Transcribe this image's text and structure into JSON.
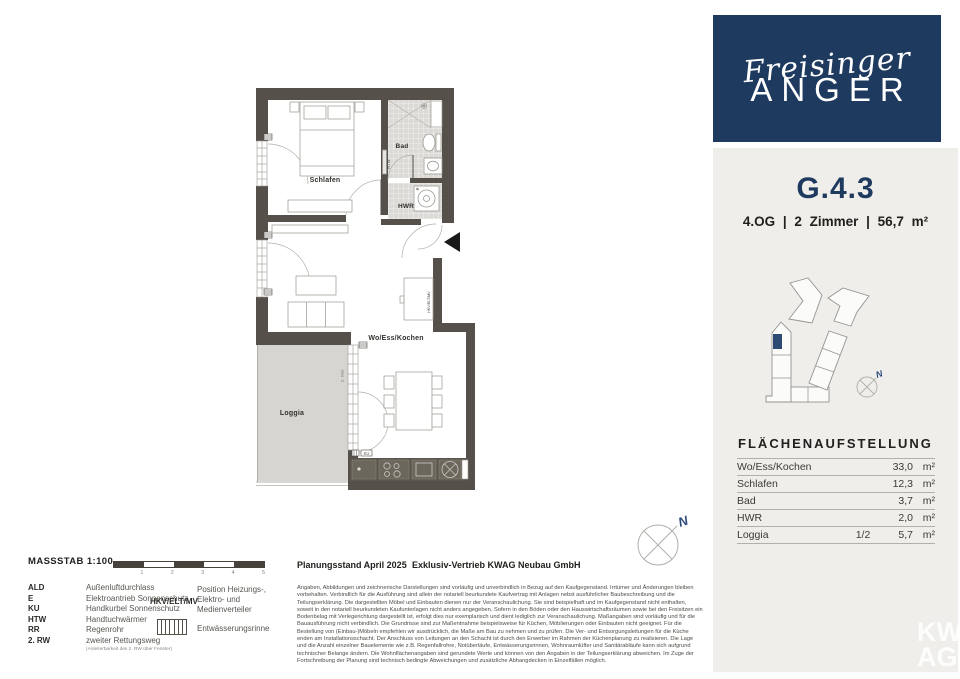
{
  "brand": {
    "script": "Freisinger",
    "caps": "ANGER"
  },
  "unit": {
    "id": "G.4.3",
    "details": "4.OG | 2 Zimmer | 56,7 m²"
  },
  "plan": {
    "rooms": {
      "schlafen": "Schlafen",
      "bad": "Bad",
      "hwr": "HWR",
      "living": "Wo/Ess/Kochen",
      "loggia": "Loggia"
    },
    "small_labels": {
      "htw": "HTW",
      "rw2": "2. RW",
      "hkv": "HKV/ELT/MV",
      "ku": "KU"
    },
    "compass_letter": "N"
  },
  "area_table": {
    "title": "FLÄCHENAUFSTELLUNG",
    "rows": [
      {
        "name": "Wo/Ess/Kochen",
        "factor": "",
        "value": "33,0",
        "unit": "m²"
      },
      {
        "name": "Schlafen",
        "factor": "",
        "value": "12,3",
        "unit": "m²"
      },
      {
        "name": "Bad",
        "factor": "",
        "value": "3,7",
        "unit": "m²"
      },
      {
        "name": "HWR",
        "factor": "",
        "value": "2,0",
        "unit": "m²"
      },
      {
        "name": "Loggia",
        "factor": "1/2",
        "value": "5,7",
        "unit": "m²"
      }
    ]
  },
  "legend": {
    "massstab": "MASSSTAB 1:100",
    "scale_ticks": [
      "1",
      "2",
      "3",
      "4",
      "5"
    ],
    "abbreviations": [
      {
        "term": "ALD",
        "def": "Außenluftdurchlass"
      },
      {
        "term": "E",
        "def": "Elektroantrieb Sonnenschutz"
      },
      {
        "term": "KU",
        "def": "Handkurbel Sonnenschutz"
      },
      {
        "term": "HTW",
        "def": "Handtuchwärmer"
      },
      {
        "term": "RR",
        "def": "Regenrohr"
      },
      {
        "term": "2. RW",
        "def": "zweiter Rettungsweg"
      }
    ],
    "rw_note": "(Anleiterbarkeit des 2. RW über Fenster)",
    "hkv_term": "HKV/ELT/MV",
    "hkv_def_line1": "Position Heizungs-,",
    "hkv_def_line2": "Elektro- und",
    "hkv_def_line3": "Medienverteiler",
    "gutter_label": "Entwässerungsrinne"
  },
  "footer": {
    "planning": "Planungsstand April 2025",
    "sales": "Exklusiv-Vertrieb  KWAG Neubau GmbH",
    "disclaimer": "Angaben, Abbildungen und zeichnerische Darstellungen sind vorläufig und unverbindlich in Bezug auf den Kaufgegenstand. Irrtümer und Änderungen bleiben vorbehalten. Verbindlich für die Ausführung sind allein der notariell beurkundete Kaufvertrag mit Anlagen nebst ausführlicher Baubeschreibung und die Teilungserklärung. Die dargestellten Möbel und Einbauten dienen nur der Veranschaulichung. Sie sind beispielhaft und im Kaufgegenstand nicht enthalten, soweit in den notariell beurkundeten Kaufunterlagen nicht anders angegeben. Sofern in den Böden oder den Hauswirtschaftsräumen sowie bei den Freisitzen ein Bodenbelag mit Verlegerichtung dargestellt ist, erfolgt dies nur exemplarisch und dient lediglich zur Veranschaulichung. Maßangaben sind vorläufig und für die Bauausführung nicht verbindlich. Die Grundrisse sind zur Maßentnahme beispielsweise für Küchen, Möblierungen oder Einbauten nicht geeignet. Für die Bestellung von (Einbau-)Möbeln empfehlen wir ausdrücklich, die Maße am Bau zu nehmen und zu prüfen. Die Ver- und Entsorgungsleitungen für die Küche enden am Installationsschacht. Der Anschluss von Leitungen an den Schacht ist durch den Erwerber im Rahmen der Küchenplanung zu realisieren. Die Lage und die Anzahl einzelner Bauelemente wie z.B. Regenfallrohre, Notüberläufe, Entwässerungsrinnen, Wohnraumlüfter und Sanitärabläufe kann sich aufgrund technischer Belange ändern. Die Wohnflächenangaben sind gerundete Werte und können von den Angaben in der Teilungserklärung abweichen. Im Zuge der Fortschreibung der Planung sind technisch bedingte Abweichungen und zusätzliche Abhangdecken in Einzelfällen möglich."
  },
  "watermark": {
    "line1": "KW",
    "line2": "AG"
  },
  "colors": {
    "navy": "#1e3a5f",
    "wall": "#55514a",
    "panel_gray": "#efeeeb",
    "loggia_gray": "#d7d5d1",
    "compass_blue": "#2b4a7c"
  }
}
